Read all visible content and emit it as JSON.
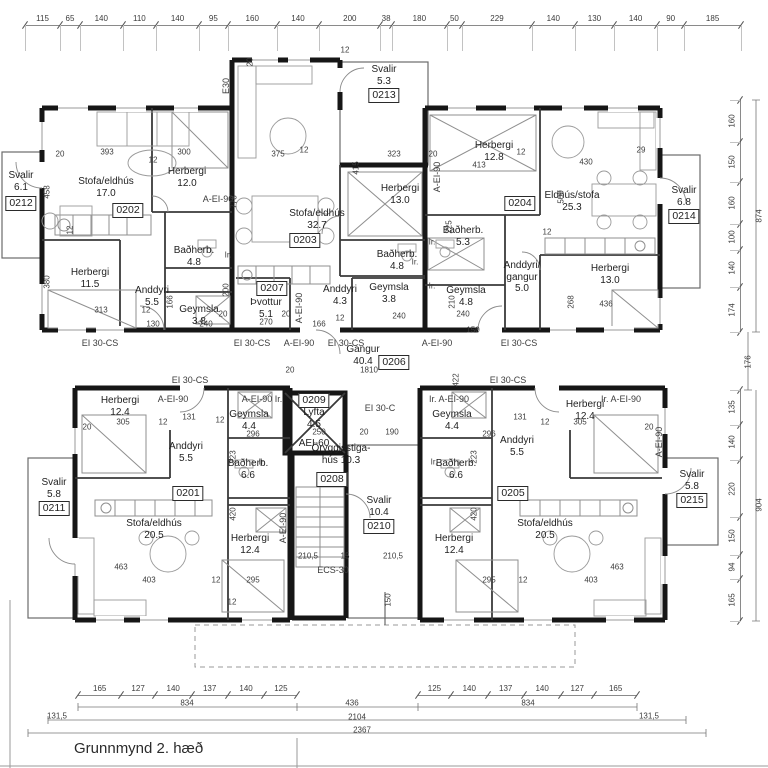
{
  "title": "Grunnmynd 2. hæð",
  "units": {
    "a0202": {
      "no": "0202",
      "stofa_n": "Stofa/eldhús",
      "stofa_a": "17.0",
      "h1_n": "Herbergi",
      "h1_a": "12.0",
      "h2_n": "Herbergi",
      "h2_a": "11.5",
      "and_n": "Anddyri",
      "and_a": "5.5",
      "bad_n": "Baðherb.",
      "bad_a": "4.8",
      "gey_n": "Geymsla",
      "gey_a": "3.8"
    },
    "a0203": {
      "no": "0203",
      "stofa_n": "Stofa/eldhús",
      "stofa_a": "32.7",
      "h1_n": "Herbergi",
      "h1_a": "13.0",
      "bad_n": "Baðherb.",
      "bad_a": "4.8",
      "and_n": "Anddyri",
      "and_a": "4.3",
      "gey_n": "Geymsla",
      "gey_a": "3.8"
    },
    "a0204": {
      "no": "0204",
      "stofa_n": "Eldhús/stofa",
      "stofa_a": "25.3",
      "h1_n": "Herbergi",
      "h1_a": "12.8",
      "h2_n": "Herbergi",
      "h2_a": "13.0",
      "bad_n": "Baðherb.",
      "bad_a": "5.3",
      "gey_n": "Geymsla",
      "gey_a": "4.8",
      "and_n1": "Anddyri/",
      "and_n2": "gangur",
      "and_a": "5.0"
    },
    "a0201": {
      "no": "0201",
      "stofa_n": "Stofa/eldhús",
      "stofa_a": "20.5",
      "h1_n": "Herbergi",
      "h1_a": "12.4",
      "h2_n": "Herbergi",
      "h2_a": "12.4",
      "and_n": "Anddyri",
      "and_a": "5.5",
      "bad_n": "Baðherb.",
      "bad_a": "6.6",
      "gey_n": "Geymsla",
      "gey_a": "4.4"
    },
    "a0205": {
      "no": "0205",
      "stofa_n": "Stofa/eldhús",
      "stofa_a": "20.5",
      "h1_n": "Herbergi",
      "h1_a": "12.4",
      "h2_n": "Herbergi",
      "h2_a": "12.4",
      "and_n": "Anddyri",
      "and_a": "5.5",
      "bad_n": "Baðherb.",
      "bad_a": "6.6",
      "gey_n": "Geymsla",
      "gey_a": "4.4"
    },
    "corridor": {
      "no": "0206",
      "n": "Gangur",
      "a": "40.4"
    },
    "laundry": {
      "no": "0207",
      "n": "Þvottur",
      "a": "5.1"
    },
    "stair": {
      "no": "0208",
      "n1": "Öryggisstiga-",
      "n2": "hús 10.3"
    },
    "lift": {
      "no": "0209",
      "n": "Lyfta",
      "a": "4.5",
      "rating": "AEI-60"
    },
    "sv0210": {
      "no": "0210",
      "n": "Svalir",
      "a": "10.4"
    },
    "sv0211": {
      "no": "0211",
      "n": "Svalir",
      "a": "5.8"
    },
    "sv0212": {
      "no": "0212",
      "n": "Svalir",
      "a": "6.1"
    },
    "sv0213": {
      "no": "0213",
      "n": "Svalir",
      "a": "5.3"
    },
    "sv0214": {
      "no": "0214",
      "n": "Svalir",
      "a": "6.8"
    },
    "sv0215": {
      "no": "0215",
      "n": "Svalir",
      "a": "5.8"
    }
  },
  "dim_chains": {
    "top": [
      115,
      65,
      140,
      110,
      140,
      95,
      160,
      140,
      200,
      38,
      180,
      50,
      229,
      140,
      130,
      140,
      90,
      185
    ],
    "bottom_left": [
      165,
      127,
      140,
      137,
      140,
      125
    ],
    "bottom_right": [
      125,
      140,
      137,
      140,
      127,
      165
    ],
    "right_upper": [
      160,
      150,
      160,
      100,
      140,
      174
    ],
    "right_lower": [
      135,
      140,
      220,
      150,
      94,
      165
    ]
  },
  "annotations": [
    {
      "t": "EI 30-CS",
      "x": 100,
      "y": 343,
      "s": 9
    },
    {
      "t": "EI 30-CS",
      "x": 252,
      "y": 343,
      "s": 9
    },
    {
      "t": "A-EI-90",
      "x": 299,
      "y": 343,
      "s": 9
    },
    {
      "t": "EI 30-CS",
      "x": 346,
      "y": 343,
      "s": 9
    },
    {
      "t": "A-EI-90",
      "x": 437,
      "y": 343,
      "s": 9
    },
    {
      "t": "EI 30-CS",
      "x": 519,
      "y": 343,
      "s": 9
    },
    {
      "t": "EI 30-CS",
      "x": 190,
      "y": 380,
      "s": 9
    },
    {
      "t": "EI 30-CS",
      "x": 508,
      "y": 380,
      "s": 9
    },
    {
      "t": "A-EI-90",
      "x": 173,
      "y": 399,
      "s": 9
    },
    {
      "t": "A-EI-90 Ir.",
      "x": 262,
      "y": 399,
      "s": 9
    },
    {
      "t": "Ir. A-EI-90",
      "x": 449,
      "y": 399,
      "s": 9
    },
    {
      "t": "Ir. A-EI-90",
      "x": 621,
      "y": 399,
      "s": 9
    },
    {
      "t": "A-EI-90",
      "x": 218,
      "y": 199,
      "s": 9
    },
    {
      "t": "A-EI-90",
      "x": 299,
      "y": 308,
      "s": 9,
      "r": 1
    },
    {
      "t": "A-EI-90",
      "x": 437,
      "y": 177,
      "s": 9,
      "r": 1
    },
    {
      "t": "A-EI-90",
      "x": 283,
      "y": 528,
      "s": 9,
      "r": 1
    },
    {
      "t": "A-EI-90",
      "x": 659,
      "y": 442,
      "s": 9,
      "r": 1
    },
    {
      "t": "E30",
      "x": 226,
      "y": 86,
      "s": 9,
      "r": 1
    },
    {
      "t": "EI 30-C",
      "x": 380,
      "y": 408,
      "s": 9
    },
    {
      "t": "ECS-30",
      "x": 333,
      "y": 570,
      "s": 9
    },
    {
      "t": "Ir.",
      "x": 228,
      "y": 255
    },
    {
      "t": "Ir.",
      "x": 415,
      "y": 262
    },
    {
      "t": "Ir.",
      "x": 432,
      "y": 242
    },
    {
      "t": "Ir.",
      "x": 432,
      "y": 286
    },
    {
      "t": "Ir.",
      "x": 262,
      "y": 462
    },
    {
      "t": "Ir.",
      "x": 434,
      "y": 462
    },
    {
      "t": "393",
      "x": 107,
      "y": 152
    },
    {
      "t": "300",
      "x": 184,
      "y": 152
    },
    {
      "t": "20",
      "x": 60,
      "y": 154
    },
    {
      "t": "12",
      "x": 153,
      "y": 160
    },
    {
      "t": "458",
      "x": 47,
      "y": 192,
      "r": 1
    },
    {
      "t": "380",
      "x": 47,
      "y": 282,
      "r": 1
    },
    {
      "t": "12",
      "x": 70,
      "y": 230,
      "r": 1
    },
    {
      "t": "313",
      "x": 101,
      "y": 310
    },
    {
      "t": "130",
      "x": 153,
      "y": 324
    },
    {
      "t": "12",
      "x": 146,
      "y": 310
    },
    {
      "t": "166",
      "x": 170,
      "y": 302,
      "r": 1
    },
    {
      "t": "200",
      "x": 226,
      "y": 290,
      "r": 1
    },
    {
      "t": "240",
      "x": 206,
      "y": 324
    },
    {
      "t": "20",
      "x": 223,
      "y": 314
    },
    {
      "t": "375",
      "x": 278,
      "y": 154
    },
    {
      "t": "12",
      "x": 304,
      "y": 150
    },
    {
      "t": "415",
      "x": 356,
      "y": 168,
      "r": 1
    },
    {
      "t": "323",
      "x": 394,
      "y": 154
    },
    {
      "t": "778",
      "x": 234,
      "y": 202,
      "r": 1
    },
    {
      "t": "270",
      "x": 266,
      "y": 322
    },
    {
      "t": "20",
      "x": 286,
      "y": 314
    },
    {
      "t": "166",
      "x": 319,
      "y": 324
    },
    {
      "t": "240",
      "x": 399,
      "y": 316
    },
    {
      "t": "12",
      "x": 340,
      "y": 318
    },
    {
      "t": "20",
      "x": 250,
      "y": 62,
      "r": 1
    },
    {
      "t": "12",
      "x": 345,
      "y": 50
    },
    {
      "t": "20",
      "x": 433,
      "y": 154
    },
    {
      "t": "413",
      "x": 479,
      "y": 165
    },
    {
      "t": "12",
      "x": 521,
      "y": 152
    },
    {
      "t": "430",
      "x": 586,
      "y": 162
    },
    {
      "t": "29",
      "x": 641,
      "y": 150
    },
    {
      "t": "500",
      "x": 561,
      "y": 197,
      "r": 1
    },
    {
      "t": "225",
      "x": 449,
      "y": 227,
      "r": 1
    },
    {
      "t": "240",
      "x": 463,
      "y": 314
    },
    {
      "t": "150",
      "x": 473,
      "y": 330
    },
    {
      "t": "210",
      "x": 452,
      "y": 302,
      "r": 1
    },
    {
      "t": "268",
      "x": 571,
      "y": 302,
      "r": 1
    },
    {
      "t": "436",
      "x": 606,
      "y": 304
    },
    {
      "t": "12",
      "x": 547,
      "y": 232
    },
    {
      "t": "1810",
      "x": 369,
      "y": 370
    },
    {
      "t": "20",
      "x": 290,
      "y": 370
    },
    {
      "t": "422",
      "x": 456,
      "y": 380,
      "r": 1
    },
    {
      "t": "250",
      "x": 319,
      "y": 432
    },
    {
      "t": "190",
      "x": 392,
      "y": 432
    },
    {
      "t": "20",
      "x": 364,
      "y": 432
    },
    {
      "t": "305",
      "x": 123,
      "y": 422
    },
    {
      "t": "131",
      "x": 189,
      "y": 417
    },
    {
      "t": "12",
      "x": 163,
      "y": 422
    },
    {
      "t": "12",
      "x": 220,
      "y": 420
    },
    {
      "t": "296",
      "x": 253,
      "y": 434
    },
    {
      "t": "223",
      "x": 233,
      "y": 457,
      "r": 1
    },
    {
      "t": "420",
      "x": 233,
      "y": 514,
      "r": 1
    },
    {
      "t": "295",
      "x": 253,
      "y": 580
    },
    {
      "t": "12",
      "x": 216,
      "y": 580
    },
    {
      "t": "403",
      "x": 149,
      "y": 580
    },
    {
      "t": "463",
      "x": 121,
      "y": 567
    },
    {
      "t": "20",
      "x": 87,
      "y": 427
    },
    {
      "t": "12",
      "x": 232,
      "y": 602
    },
    {
      "t": "305",
      "x": 580,
      "y": 422
    },
    {
      "t": "131",
      "x": 520,
      "y": 417
    },
    {
      "t": "12",
      "x": 545,
      "y": 422
    },
    {
      "t": "296",
      "x": 489,
      "y": 434
    },
    {
      "t": "223",
      "x": 474,
      "y": 457,
      "r": 1
    },
    {
      "t": "420",
      "x": 474,
      "y": 514,
      "r": 1
    },
    {
      "t": "295",
      "x": 489,
      "y": 580
    },
    {
      "t": "12",
      "x": 523,
      "y": 580
    },
    {
      "t": "403",
      "x": 591,
      "y": 580
    },
    {
      "t": "463",
      "x": 617,
      "y": 567
    },
    {
      "t": "20",
      "x": 649,
      "y": 427
    },
    {
      "t": "210,5",
      "x": 308,
      "y": 556
    },
    {
      "t": "15",
      "x": 345,
      "y": 556
    },
    {
      "t": "210,5",
      "x": 393,
      "y": 556
    },
    {
      "t": "150",
      "x": 388,
      "y": 600,
      "r": 1
    },
    {
      "t": "834",
      "x": 187,
      "y": 703
    },
    {
      "t": "436",
      "x": 352,
      "y": 703
    },
    {
      "t": "834",
      "x": 528,
      "y": 703
    },
    {
      "t": "131,5",
      "x": 57,
      "y": 716
    },
    {
      "t": "2104",
      "x": 357,
      "y": 717
    },
    {
      "t": "131,5",
      "x": 649,
      "y": 716
    },
    {
      "t": "2367",
      "x": 362,
      "y": 730
    },
    {
      "t": "874",
      "x": 759,
      "y": 216,
      "r": 1
    },
    {
      "t": "176",
      "x": 748,
      "y": 362,
      "r": 1
    },
    {
      "t": "904",
      "x": 759,
      "y": 505,
      "r": 1
    }
  ]
}
